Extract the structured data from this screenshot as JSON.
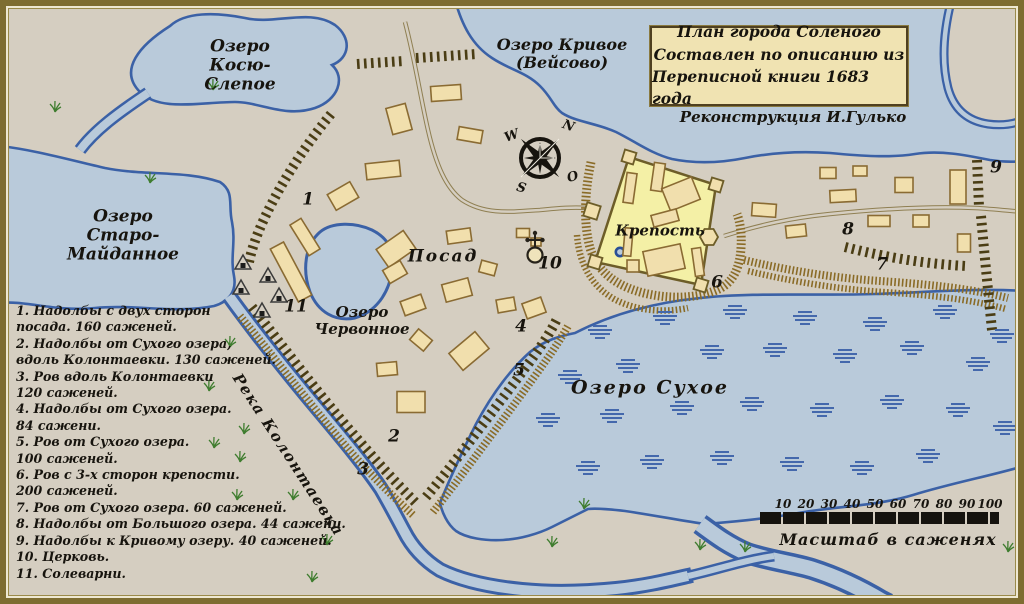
{
  "title_box": {
    "lines": [
      "План города Соленого",
      "Составлен по описанию из",
      "Переписной книги 1683 года"
    ]
  },
  "credit": "Реконструкция И.Гулько",
  "legend": {
    "lines": [
      "1. Надолбы с двух сторон",
      "посада. 160 саженей.",
      "2. Надолбы от Сухого озера,",
      "вдоль Колонтаевки. 130 саженей.",
      "3. Ров вдоль Колонтаевки",
      "120 саженей.",
      "4. Надолбы от Сухого озера.",
      "84 сажени.",
      "5. Ров от Сухого озера.",
      "100 саженей.",
      "6. Ров с 3-х сторон крепости.",
      "200 саженей.",
      "7. Ров от Сухого озера. 60 саженей.",
      "8. Надолбы от Большого озера. 44 сажени.",
      "9. Надолбы к Кривому озеру. 40 саженей.",
      "10. Церковь.",
      "11. Солеварни."
    ]
  },
  "scale": {
    "labels": [
      "10",
      "20",
      "30",
      "40",
      "50",
      "60",
      "70",
      "80",
      "90",
      "100"
    ],
    "caption": "Масштаб в саженях"
  },
  "labels": [
    {
      "id": "lake-koso",
      "text": "Озеро\nКосю-\nСлепое",
      "x": 240,
      "y": 66,
      "size": 17
    },
    {
      "id": "lake-krivoe",
      "text": "Озеро Кривое\n(Вейсово)",
      "x": 562,
      "y": 54,
      "size": 16
    },
    {
      "id": "lake-staro",
      "text": "Озеро\nСтаро-\nМайданное",
      "x": 123,
      "y": 236,
      "size": 17
    },
    {
      "id": "lake-chervonnoe",
      "text": "Озеро\nЧервонное",
      "x": 362,
      "y": 321,
      "size": 15
    },
    {
      "id": "lake-sukhoe",
      "text": "Озеро Сухое",
      "x": 650,
      "y": 388,
      "size": 19,
      "spacing": 2
    },
    {
      "id": "posad",
      "text": "Посад",
      "x": 443,
      "y": 257,
      "size": 17,
      "spacing": 2
    },
    {
      "id": "krepost",
      "text": "Крепость",
      "x": 660,
      "y": 231,
      "size": 15
    },
    {
      "id": "river",
      "text": "Река Колонтаевка",
      "x": 288,
      "y": 455,
      "size": 15,
      "rot": 57,
      "spacing": 1.5
    },
    {
      "id": "marker-1",
      "text": "1",
      "x": 308,
      "y": 200,
      "size": 17
    },
    {
      "id": "marker-2",
      "text": "2",
      "x": 394,
      "y": 437,
      "size": 17
    },
    {
      "id": "marker-3",
      "text": "3",
      "x": 363,
      "y": 470,
      "size": 17
    },
    {
      "id": "marker-4",
      "text": "4",
      "x": 521,
      "y": 327,
      "size": 17
    },
    {
      "id": "marker-5",
      "text": "5",
      "x": 519,
      "y": 371,
      "size": 17
    },
    {
      "id": "marker-6",
      "text": "6",
      "x": 717,
      "y": 283,
      "size": 17
    },
    {
      "id": "marker-7",
      "text": "7",
      "x": 882,
      "y": 265,
      "size": 17
    },
    {
      "id": "marker-8",
      "text": "8",
      "x": 848,
      "y": 230,
      "size": 17
    },
    {
      "id": "marker-9",
      "text": "9",
      "x": 996,
      "y": 168,
      "size": 17
    },
    {
      "id": "marker-10",
      "text": "10",
      "x": 550,
      "y": 264,
      "size": 17
    },
    {
      "id": "marker-11",
      "text": "11",
      "x": 296,
      "y": 307,
      "size": 17
    },
    {
      "id": "compass-w",
      "text": "W",
      "x": 512,
      "y": 137,
      "size": 13,
      "rot": -20
    },
    {
      "id": "compass-n",
      "text": "N",
      "x": 568,
      "y": 127,
      "size": 13,
      "rot": 20
    },
    {
      "id": "compass-o",
      "text": "O",
      "x": 573,
      "y": 178,
      "size": 13,
      "rot": -15
    },
    {
      "id": "compass-s",
      "text": "S",
      "x": 521,
      "y": 189,
      "size": 13,
      "rot": 15
    }
  ],
  "houses": [
    [
      446,
      93,
      30,
      15,
      -4
    ],
    [
      399,
      119,
      20,
      27,
      -15
    ],
    [
      383,
      170,
      34,
      16,
      -6
    ],
    [
      470,
      135,
      24,
      13,
      10
    ],
    [
      459,
      236,
      24,
      13,
      -8
    ],
    [
      396,
      249,
      33,
      22,
      -35
    ],
    [
      395,
      272,
      20,
      15,
      -30
    ],
    [
      413,
      305,
      22,
      15,
      -20
    ],
    [
      457,
      290,
      27,
      18,
      -15
    ],
    [
      488,
      268,
      16,
      12,
      15
    ],
    [
      506,
      305,
      18,
      13,
      -10
    ],
    [
      534,
      308,
      20,
      16,
      -20
    ],
    [
      421,
      340,
      18,
      14,
      40
    ],
    [
      387,
      369,
      20,
      13,
      -5
    ],
    [
      469,
      351,
      34,
      22,
      -40
    ],
    [
      411,
      402,
      28,
      21,
      0
    ],
    [
      343,
      196,
      26,
      18,
      -30
    ],
    [
      291,
      272,
      60,
      15,
      62
    ],
    [
      305,
      237,
      36,
      13,
      58
    ],
    [
      843,
      196,
      26,
      12,
      -3
    ],
    [
      860,
      171,
      14,
      10,
      0
    ],
    [
      904,
      185,
      18,
      15,
      0
    ],
    [
      958,
      187,
      16,
      34,
      0
    ],
    [
      879,
      221,
      22,
      11,
      0
    ],
    [
      921,
      221,
      16,
      12,
      0
    ],
    [
      964,
      243,
      13,
      18,
      0
    ],
    [
      828,
      173,
      16,
      11,
      0
    ],
    [
      764,
      210,
      24,
      13,
      4
    ],
    [
      796,
      231,
      20,
      12,
      -6
    ],
    [
      630,
      188,
      10,
      30,
      8
    ],
    [
      658,
      177,
      11,
      28,
      8
    ],
    [
      681,
      194,
      32,
      24,
      -22
    ],
    [
      665,
      218,
      26,
      12,
      -15
    ],
    [
      664,
      260,
      38,
      25,
      -12
    ],
    [
      628,
      242,
      8,
      28,
      5
    ],
    [
      698,
      262,
      9,
      28,
      -8
    ],
    [
      633,
      266,
      12,
      12,
      0
    ],
    [
      523,
      233,
      13,
      9,
      0
    ],
    [
      536,
      242,
      10,
      8,
      0
    ]
  ],
  "salt_works": [
    [
      243,
      263
    ],
    [
      268,
      276
    ],
    [
      241,
      288
    ],
    [
      279,
      296
    ],
    [
      262,
      311
    ]
  ],
  "marsh": [
    [
      600,
      332
    ],
    [
      665,
      318
    ],
    [
      735,
      312
    ],
    [
      805,
      318
    ],
    [
      875,
      324
    ],
    [
      945,
      312
    ],
    [
      1002,
      336
    ],
    [
      570,
      377
    ],
    [
      628,
      366
    ],
    [
      712,
      352
    ],
    [
      775,
      350
    ],
    [
      845,
      356
    ],
    [
      912,
      348
    ],
    [
      978,
      364
    ],
    [
      548,
      420
    ],
    [
      612,
      416
    ],
    [
      682,
      408
    ],
    [
      752,
      404
    ],
    [
      822,
      410
    ],
    [
      892,
      402
    ],
    [
      958,
      410
    ],
    [
      1005,
      428
    ],
    [
      588,
      468
    ],
    [
      652,
      462
    ],
    [
      722,
      458
    ],
    [
      792,
      464
    ],
    [
      862,
      468
    ],
    [
      928,
      456
    ]
  ],
  "grass": [
    [
      55,
      112
    ],
    [
      150,
      183
    ],
    [
      213,
      90
    ],
    [
      230,
      347
    ],
    [
      209,
      391
    ],
    [
      244,
      434
    ],
    [
      214,
      448
    ],
    [
      240,
      462
    ],
    [
      237,
      500
    ],
    [
      293,
      500
    ],
    [
      327,
      545
    ],
    [
      312,
      582
    ],
    [
      552,
      547
    ],
    [
      584,
      509
    ],
    [
      700,
      550
    ],
    [
      745,
      552
    ],
    [
      1008,
      552
    ]
  ],
  "colors": {
    "land": "#d5cec1",
    "water": "#b9cada",
    "water_line": "#3b61a6",
    "house": "#f1dfad",
    "house_line": "#8a6b33",
    "fortress": "#f4f0a6",
    "fortress_line": "#6d5d28",
    "palisade": "#4a3d14",
    "ditch": "#8a6b26",
    "road": "#8f7f52",
    "marsh": "#4468ac",
    "grass": "#3f7d2f",
    "text": "#17140e"
  }
}
